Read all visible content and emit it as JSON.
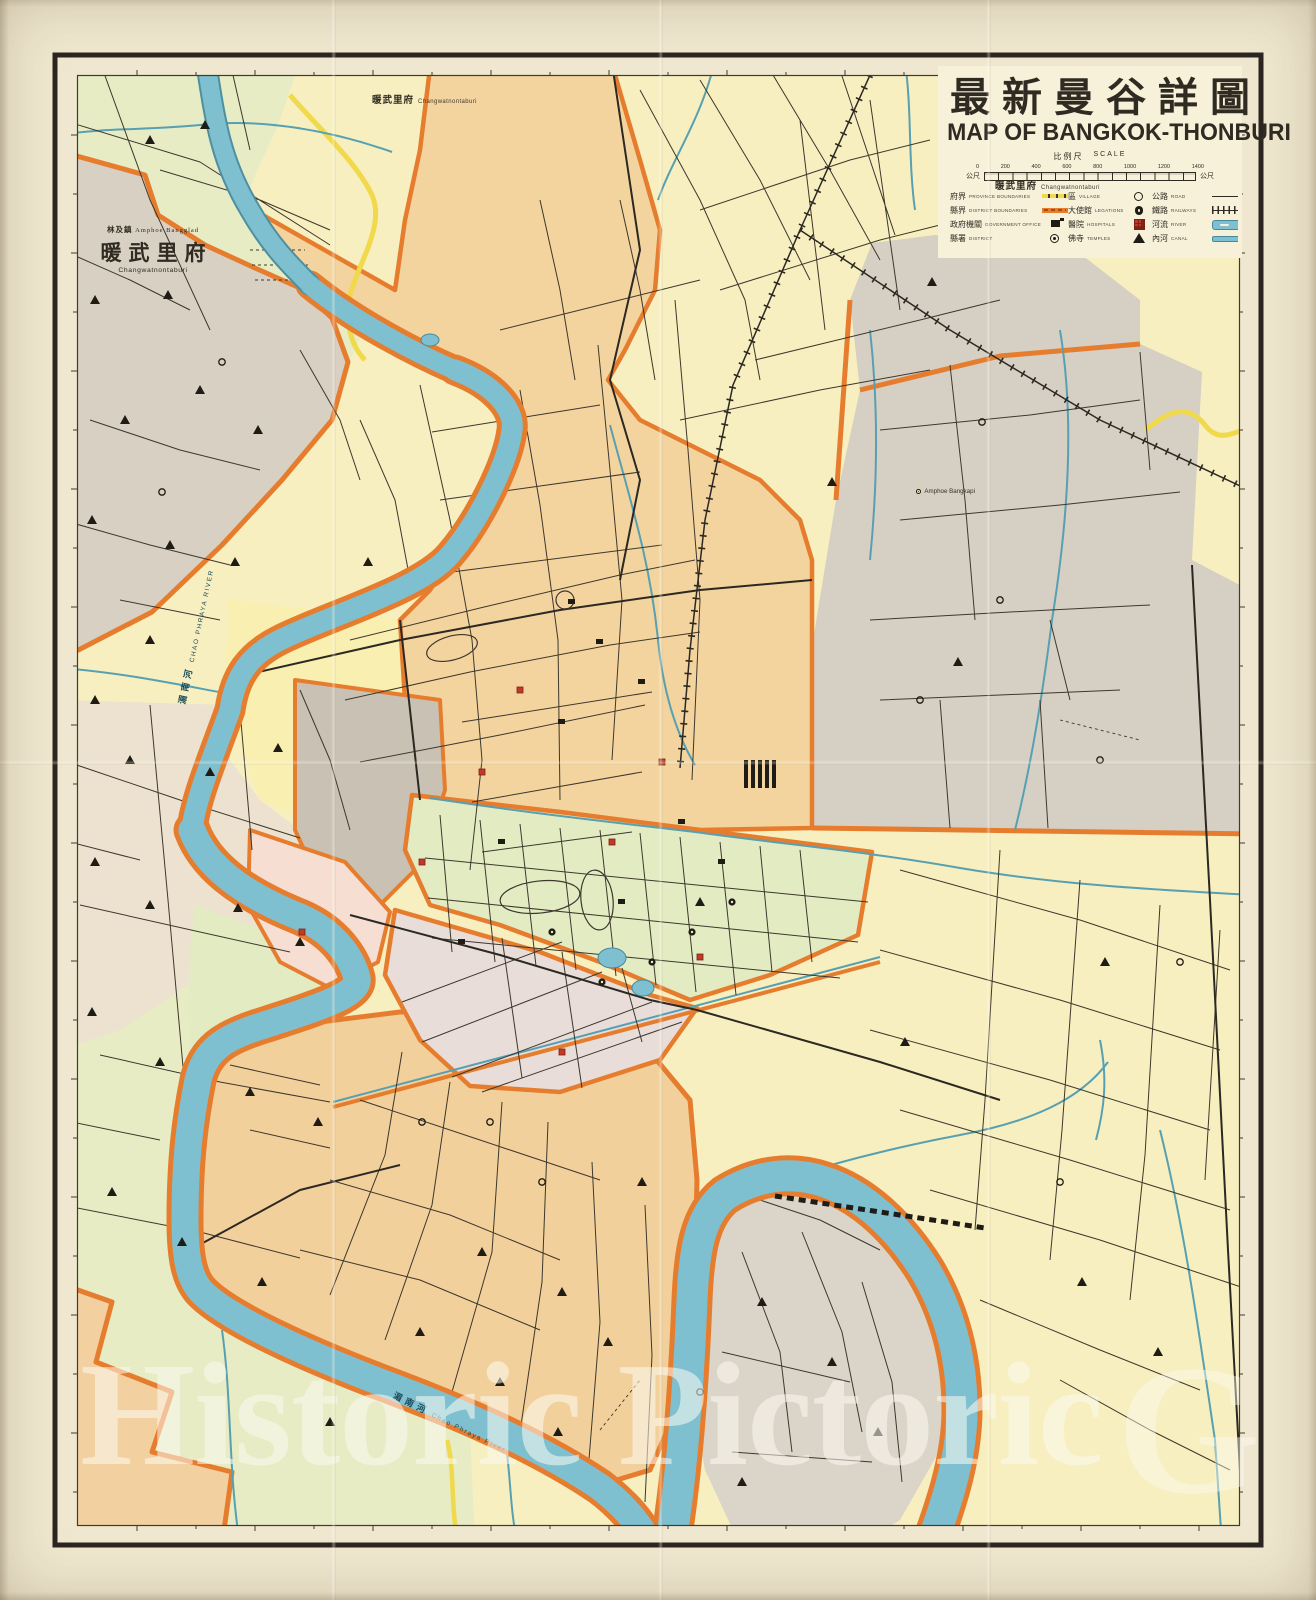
{
  "title": {
    "chinese": "最新曼谷詳圖",
    "english": "MAP OF BANGKOK-THONBURI"
  },
  "scale_bar": {
    "label_cn": "比例尺",
    "label_en": "SCALE",
    "unit_left": "公尺",
    "unit_right": "公尺",
    "ticks": [
      "0",
      "200",
      "400",
      "600",
      "800",
      "1000",
      "1200",
      "1400"
    ]
  },
  "legend": {
    "items": [
      {
        "cn": "府界",
        "en": "PROVINCE BOUNDARIES",
        "symbol": "province-boundary"
      },
      {
        "cn": "縣界",
        "en": "DISTRICT BOUNDARIES",
        "symbol": "district-boundary"
      },
      {
        "cn": "政府機關",
        "en": "GOVERNMENT OFFICE",
        "symbol": "government-office"
      },
      {
        "cn": "縣署",
        "en": "DISTRICT",
        "symbol": "district-office"
      },
      {
        "cn": "區",
        "en": "VILLAGE",
        "symbol": "village"
      },
      {
        "cn": "大使館",
        "en": "LEGATIONS",
        "symbol": "legation"
      },
      {
        "cn": "醫院",
        "en": "HOSPITALS",
        "symbol": "hospital"
      },
      {
        "cn": "佛寺",
        "en": "TEMPLES",
        "symbol": "temple"
      },
      {
        "cn": "公路",
        "en": "ROAD",
        "symbol": "road"
      },
      {
        "cn": "鐵路",
        "en": "RAILWAYS",
        "symbol": "railway"
      },
      {
        "cn": "河流",
        "en": "RIVER",
        "symbol": "river"
      },
      {
        "cn": "內河",
        "en": "CANAL",
        "symbol": "canal"
      }
    ]
  },
  "map_labels": {
    "nonthaburi_big": {
      "sub_cn": "林及鎮",
      "sub_en": "Amphoe Bangglad",
      "cn": "暖武里府",
      "en": "Changwatnontaburi"
    },
    "nonthaburi_top": {
      "cn": "暖武里府",
      "en": "Changwatnontaburi"
    },
    "nonthaburi_right": {
      "cn": "暖武里府",
      "en": "Changwatnontaburi"
    },
    "river_upper": {
      "cn": "湄南河",
      "en": "CHAO PHRAYA RIVER"
    },
    "river_lower": {
      "cn": "湄南河",
      "en": "Chao Phraya River"
    },
    "bangkapi": {
      "en": "Amphoe Bangkapi"
    }
  },
  "watermark": {
    "text": "Historic Pictoric",
    "mark": "G"
  },
  "palette": {
    "paper": "#efe7cf",
    "map_base": "#f7efbf",
    "farmland_green": "#e7ecc4",
    "province_gray": "#d8d0c2",
    "district_peach": "#f3d49e",
    "old_city_cream": "#f8efb1",
    "chinatown_gray": "#c9c1b3",
    "pink_district": "#f6ded3",
    "pathumwan_green": "#e3ebc3",
    "bangrak_lavender": "#e8ddd8",
    "river_blue": "#7fc0d0",
    "canal_blue": "#57a0b2",
    "boundary_orange": "#e67d2e",
    "province_yellow": "#f0d94a",
    "road_dark": "#3d372d",
    "hospital_red": "#bf3a28",
    "ink": "#2f2b22"
  }
}
